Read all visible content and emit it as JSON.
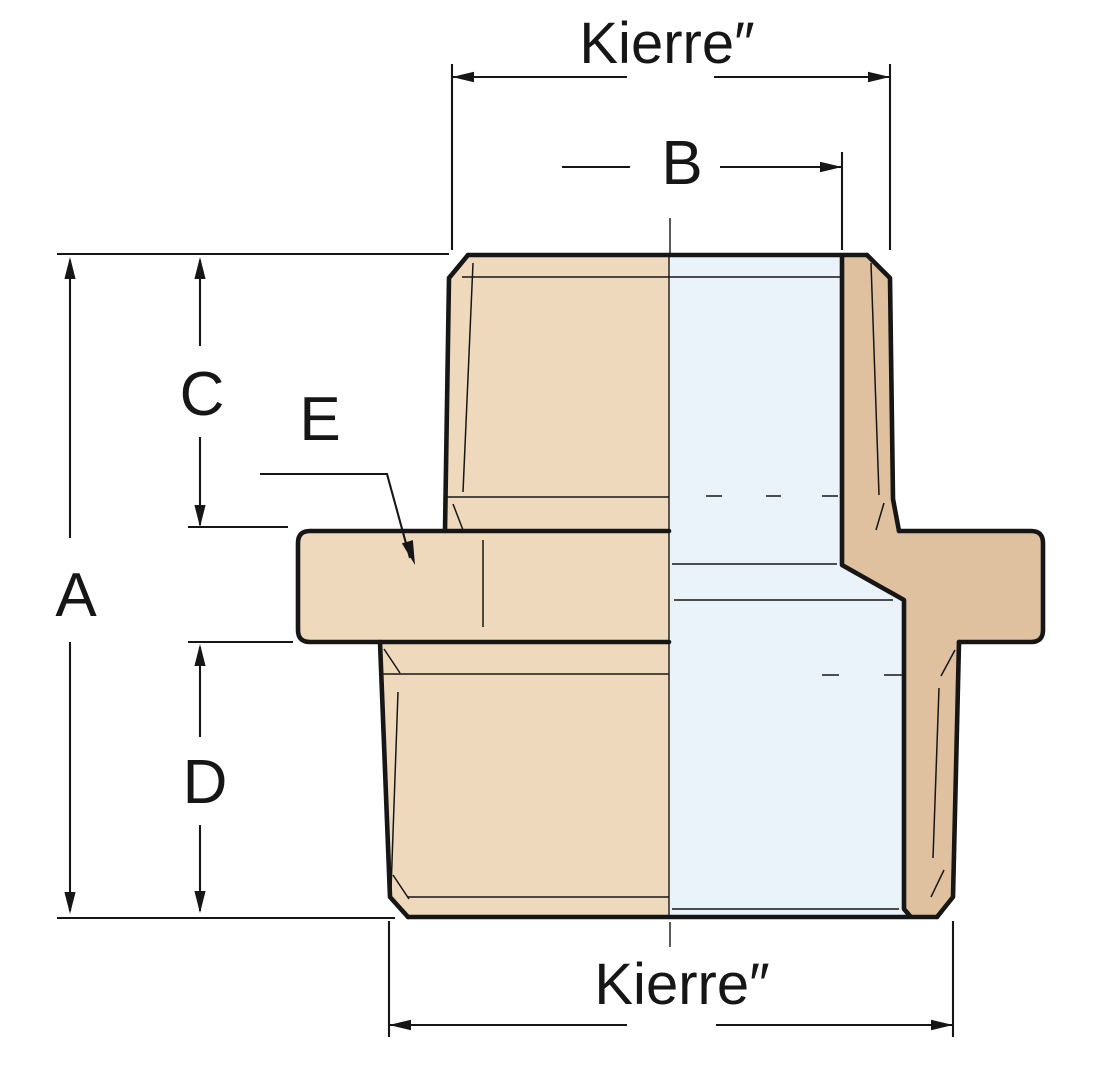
{
  "drawing_labels": {
    "thread_top": "Kierre″",
    "thread_bottom": "Kierre″",
    "dim_a": "A",
    "dim_b": "B",
    "dim_c": "C",
    "dim_d": "D",
    "dim_e": "E"
  },
  "colors": {
    "body_external": "#EFD9BD",
    "body_section": "#DFC1A0",
    "bore_section": "#EAF3FA",
    "line": "#161616",
    "background": "#FFFFFF"
  }
}
